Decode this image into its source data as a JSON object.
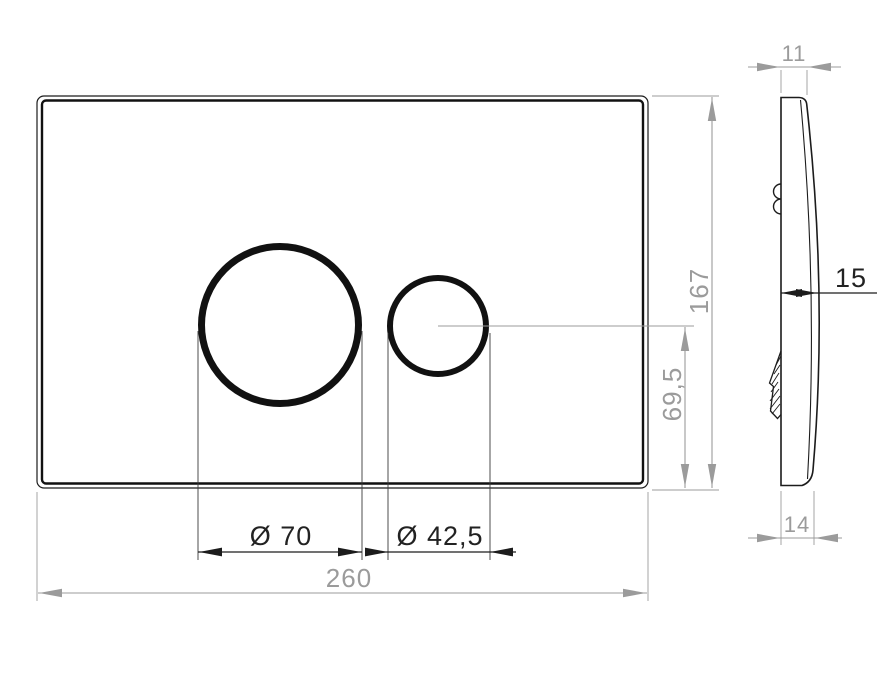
{
  "drawing": {
    "type": "technical-drawing",
    "views": {
      "front": "flush-plate front view with two round buttons",
      "side": "flush-plate side profile view"
    },
    "colors": {
      "line_black": "#1c1c1c",
      "dimension_gray": "#9b9b9b",
      "background": "#ffffff"
    },
    "labels": {
      "large_button_diameter": "Ø 70",
      "small_button_diameter": "Ø 42,5",
      "plate_width": "260",
      "plate_height": "167",
      "button_axis_height": "69,5",
      "top_edge_depth": "11",
      "mid_depth": "15",
      "bottom_edge_depth": "14"
    }
  }
}
